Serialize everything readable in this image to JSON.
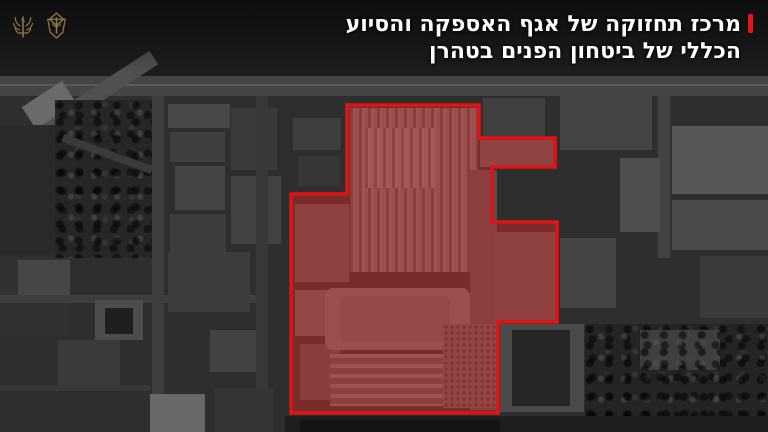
{
  "header": {
    "title_line1": "מרכז תחזוקה של אגף האספקה והסיוע",
    "title_line2": "הכללי של ביטחון הפנים בטהרן",
    "accent_color": "#e8121a",
    "text_color": "#ffffff"
  },
  "icons": {
    "left": "signal-corps-emblem",
    "right": "idf-emblem",
    "gold_color": "#9d8449"
  },
  "overlay": {
    "stroke_color": "#e01414",
    "stroke_width": 3.5,
    "fill_color": "rgba(214,40,40,0.45)",
    "polygon_points": [
      [
        347,
        105
      ],
      [
        479,
        105
      ],
      [
        479,
        138
      ],
      [
        555,
        138
      ],
      [
        555,
        167
      ],
      [
        492,
        167
      ],
      [
        492,
        222
      ],
      [
        557,
        222
      ],
      [
        557,
        322
      ],
      [
        498,
        322
      ],
      [
        498,
        413
      ],
      [
        291,
        413
      ],
      [
        291,
        194
      ],
      [
        347,
        194
      ]
    ]
  },
  "scenery": {
    "base_color": "#2e2e2e",
    "rects": [
      {
        "x": 0,
        "y": 0,
        "w": 768,
        "h": 76,
        "c": "#1d1d1d"
      },
      {
        "x": 0,
        "y": 76,
        "w": 768,
        "h": 20,
        "c": "#454545"
      },
      {
        "x": 0,
        "y": 84,
        "w": 768,
        "h": 2,
        "c": "#5a5a5a"
      },
      {
        "x": -30,
        "y": 104,
        "w": 200,
        "h": 16,
        "c": "#505050",
        "rot": -33
      },
      {
        "x": 25,
        "y": 92,
        "w": 48,
        "h": 26,
        "c": "#6a6a6a",
        "rot": -33
      },
      {
        "x": 0,
        "y": 125,
        "w": 55,
        "h": 130,
        "c": "#2a2a2a"
      },
      {
        "x": 55,
        "y": 100,
        "w": 100,
        "h": 158,
        "c": "#262626",
        "tex": "blobs"
      },
      {
        "x": 60,
        "y": 150,
        "w": 95,
        "h": 8,
        "c": "#3a3a3a",
        "rot": 20
      },
      {
        "x": 152,
        "y": 96,
        "w": 12,
        "h": 336,
        "c": "#3e3e3e"
      },
      {
        "x": 168,
        "y": 104,
        "w": 62,
        "h": 24,
        "c": "#484848"
      },
      {
        "x": 170,
        "y": 132,
        "w": 55,
        "h": 30,
        "c": "#3f3f3f"
      },
      {
        "x": 231,
        "y": 108,
        "w": 46,
        "h": 62,
        "c": "#3a3a3a"
      },
      {
        "x": 175,
        "y": 166,
        "w": 50,
        "h": 44,
        "c": "#454545"
      },
      {
        "x": 231,
        "y": 176,
        "w": 50,
        "h": 68,
        "c": "#424242"
      },
      {
        "x": 170,
        "y": 214,
        "w": 56,
        "h": 58,
        "c": "#3c3c3c"
      },
      {
        "x": 256,
        "y": 96,
        "w": 12,
        "h": 336,
        "c": "#383838"
      },
      {
        "x": 0,
        "y": 258,
        "w": 70,
        "h": 78,
        "c": "#313131"
      },
      {
        "x": 18,
        "y": 260,
        "w": 52,
        "h": 40,
        "c": "#464646"
      },
      {
        "x": 0,
        "y": 295,
        "w": 256,
        "h": 8,
        "c": "#3e3e3e"
      },
      {
        "x": 95,
        "y": 300,
        "w": 48,
        "h": 40,
        "c": "#4d4d4d"
      },
      {
        "x": 105,
        "y": 308,
        "w": 28,
        "h": 26,
        "c": "#1f1f1f"
      },
      {
        "x": 58,
        "y": 340,
        "w": 62,
        "h": 50,
        "c": "#3a3a3a"
      },
      {
        "x": 168,
        "y": 252,
        "w": 82,
        "h": 60,
        "c": "#3c3c3c"
      },
      {
        "x": 210,
        "y": 330,
        "w": 46,
        "h": 42,
        "c": "#424242"
      },
      {
        "x": 0,
        "y": 385,
        "w": 150,
        "h": 6,
        "c": "#383838"
      },
      {
        "x": 150,
        "y": 394,
        "w": 55,
        "h": 38,
        "c": "#686868"
      },
      {
        "x": 214,
        "y": 388,
        "w": 60,
        "h": 44,
        "c": "#343434"
      },
      {
        "x": 293,
        "y": 118,
        "w": 48,
        "h": 32,
        "c": "#3e3e3e"
      },
      {
        "x": 298,
        "y": 156,
        "w": 42,
        "h": 30,
        "c": "#363636"
      },
      {
        "x": 483,
        "y": 98,
        "w": 62,
        "h": 40,
        "c": "#404040"
      },
      {
        "x": 560,
        "y": 94,
        "w": 92,
        "h": 56,
        "c": "#444444"
      },
      {
        "x": 658,
        "y": 96,
        "w": 12,
        "h": 162,
        "c": "#424242"
      },
      {
        "x": 620,
        "y": 158,
        "w": 40,
        "h": 74,
        "c": "#4e4e4e"
      },
      {
        "x": 672,
        "y": 126,
        "w": 96,
        "h": 68,
        "c": "#575757"
      },
      {
        "x": 672,
        "y": 200,
        "w": 96,
        "h": 50,
        "c": "#4b4b4b"
      },
      {
        "x": 700,
        "y": 256,
        "w": 68,
        "h": 62,
        "c": "#3a3a3a"
      },
      {
        "x": 560,
        "y": 238,
        "w": 56,
        "h": 70,
        "c": "#454545"
      },
      {
        "x": 585,
        "y": 324,
        "w": 183,
        "h": 108,
        "c": "#242424",
        "tex": "blobs"
      },
      {
        "x": 640,
        "y": 330,
        "w": 80,
        "h": 40,
        "c": "#3f3f3f",
        "tex": "blobs"
      },
      {
        "x": 500,
        "y": 324,
        "w": 84,
        "h": 88,
        "c": "#4a4a4a"
      },
      {
        "x": 512,
        "y": 330,
        "w": 58,
        "h": 76,
        "c": "#262626"
      },
      {
        "x": 285,
        "y": 416,
        "w": 483,
        "h": 16,
        "c": "#1e1e1e"
      },
      {
        "x": 300,
        "y": 420,
        "w": 200,
        "h": 12,
        "c": "#141414"
      },
      {
        "x": 350,
        "y": 108,
        "w": 128,
        "h": 164,
        "c": "#6e6e6e",
        "tex": "stripesV"
      },
      {
        "x": 365,
        "y": 128,
        "w": 70,
        "h": 60,
        "c": "#7a7a7a",
        "tex": "stripesV"
      },
      {
        "x": 480,
        "y": 140,
        "w": 73,
        "h": 27,
        "c": "#5a5a5a"
      },
      {
        "x": 470,
        "y": 170,
        "w": 27,
        "h": 240,
        "c": "#515151"
      },
      {
        "x": 495,
        "y": 232,
        "w": 60,
        "h": 88,
        "c": "#565656"
      },
      {
        "x": 295,
        "y": 204,
        "w": 54,
        "h": 78,
        "c": "#555555"
      },
      {
        "x": 295,
        "y": 290,
        "w": 42,
        "h": 46,
        "c": "#5f5f5f"
      },
      {
        "x": 300,
        "y": 344,
        "w": 40,
        "h": 56,
        "c": "#4f4f4f"
      },
      {
        "x": 325,
        "y": 288,
        "w": 145,
        "h": 62,
        "c": "#6d6d6d",
        "rad": 8
      },
      {
        "x": 340,
        "y": 296,
        "w": 110,
        "h": 46,
        "c": "#636363",
        "rad": 6
      },
      {
        "x": 330,
        "y": 354,
        "w": 140,
        "h": 52,
        "c": "#646464",
        "tex": "stripesH"
      },
      {
        "x": 443,
        "y": 324,
        "w": 55,
        "h": 84,
        "c": "#5c5c5c",
        "tex": "dots"
      }
    ]
  }
}
